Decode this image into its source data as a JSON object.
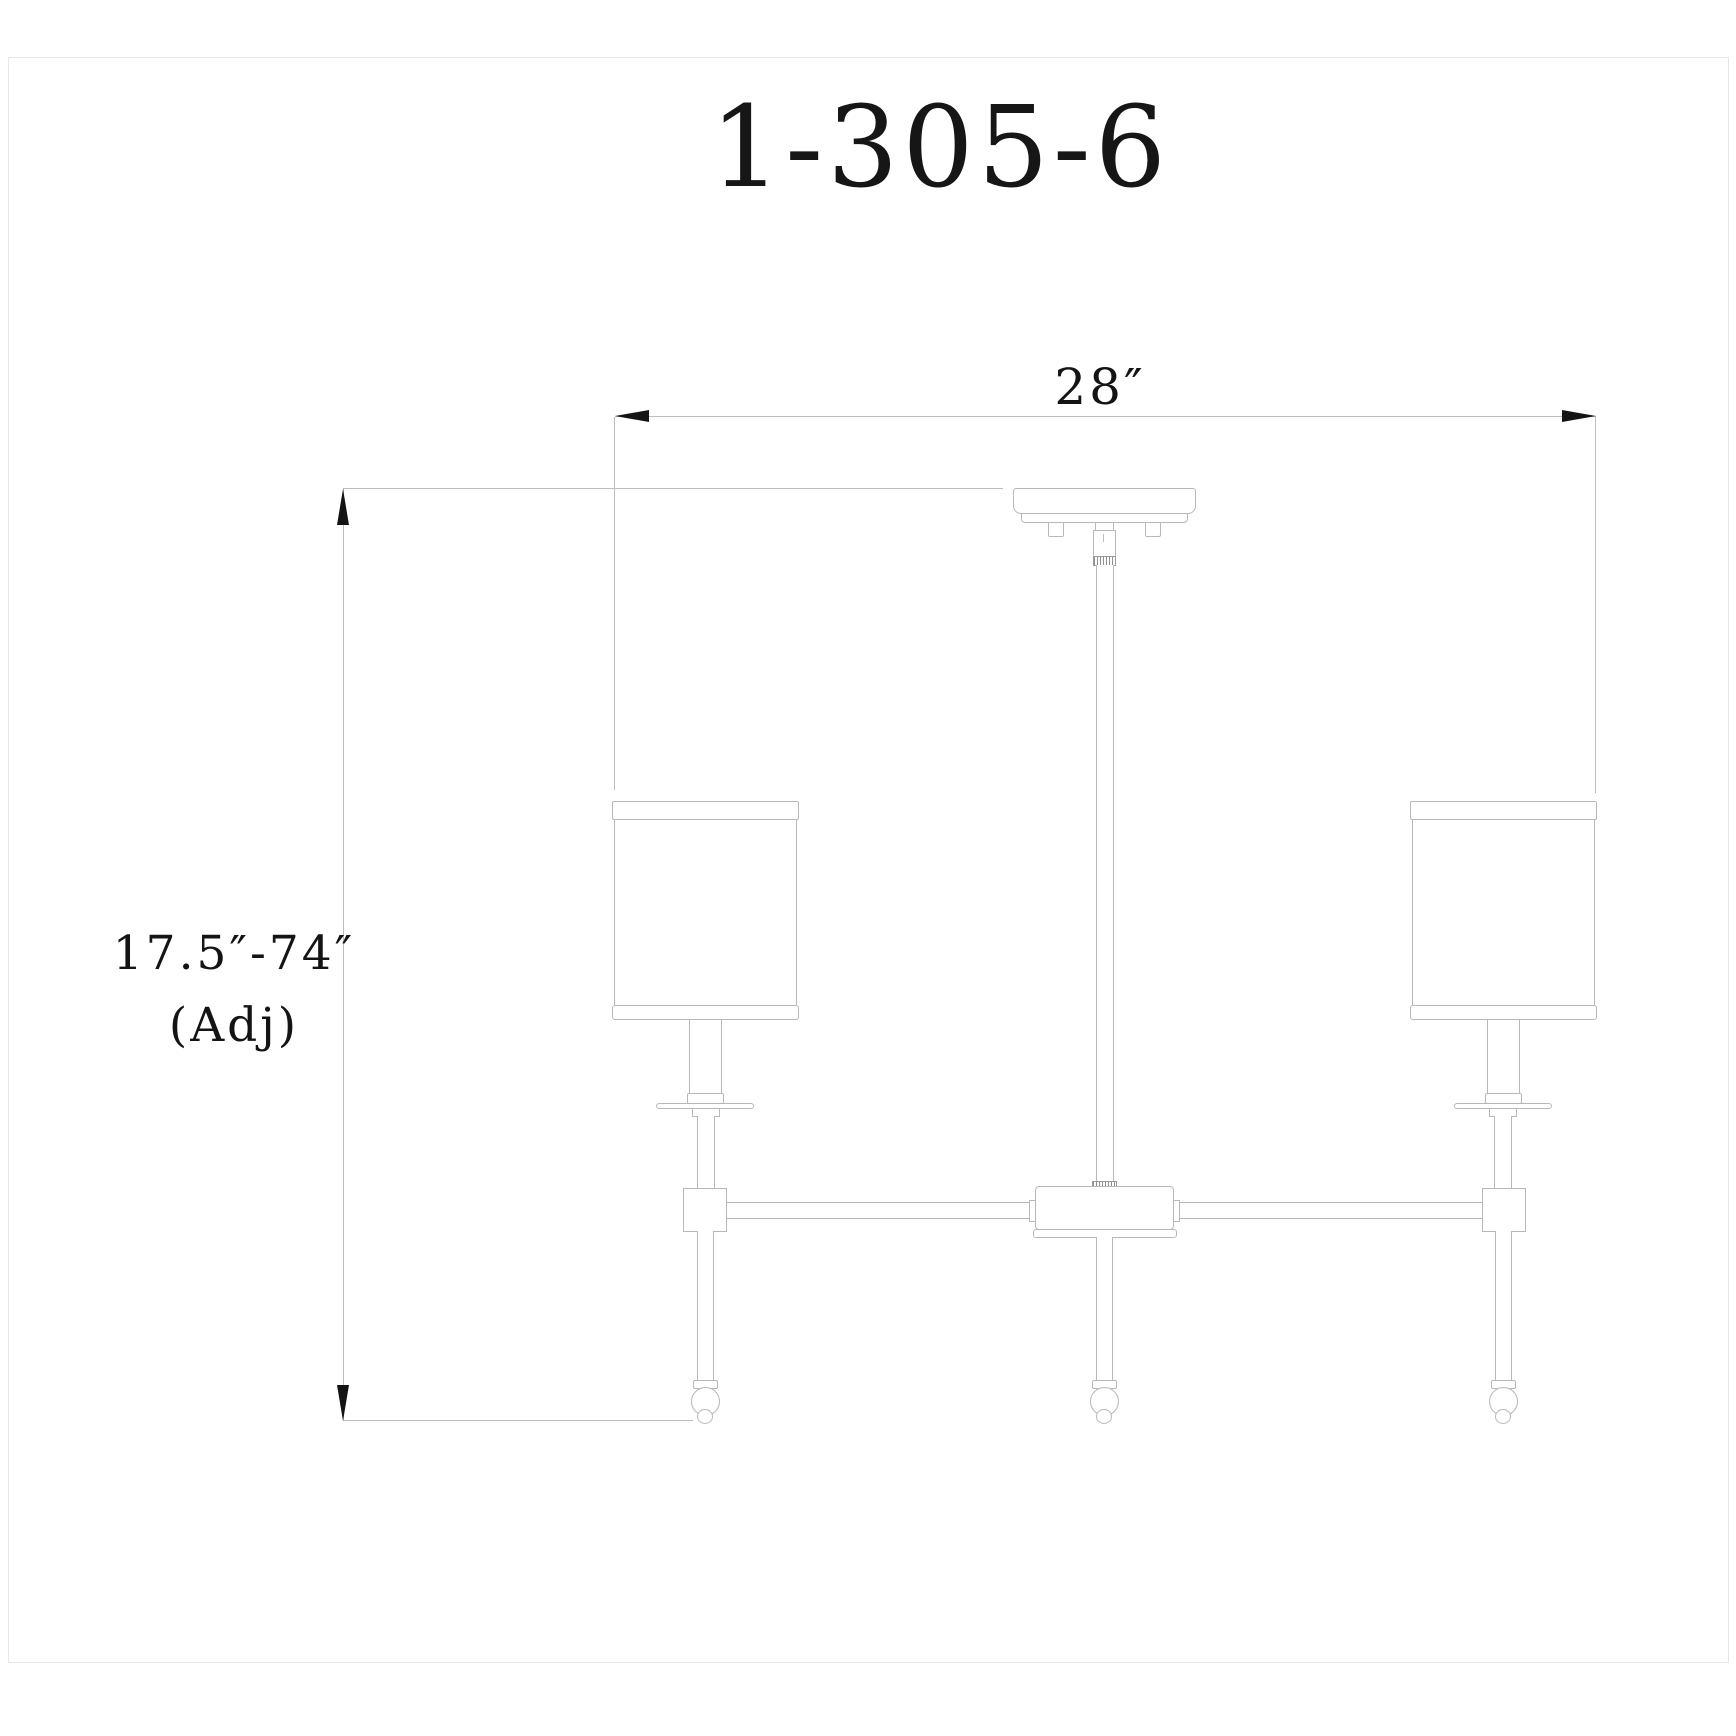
{
  "page": {
    "title": "1-305-6",
    "background_color": "#ffffff",
    "line_color": "#b8b8b8",
    "ink_color": "#141414"
  },
  "drawing": {
    "kind": "technical-dimension-drawing",
    "subject": "three-light linear chandelier, side elevation"
  },
  "dimensions": {
    "width": {
      "label": "28″"
    },
    "height": {
      "range": "17.5″-74″",
      "note": "(Adj)"
    }
  }
}
